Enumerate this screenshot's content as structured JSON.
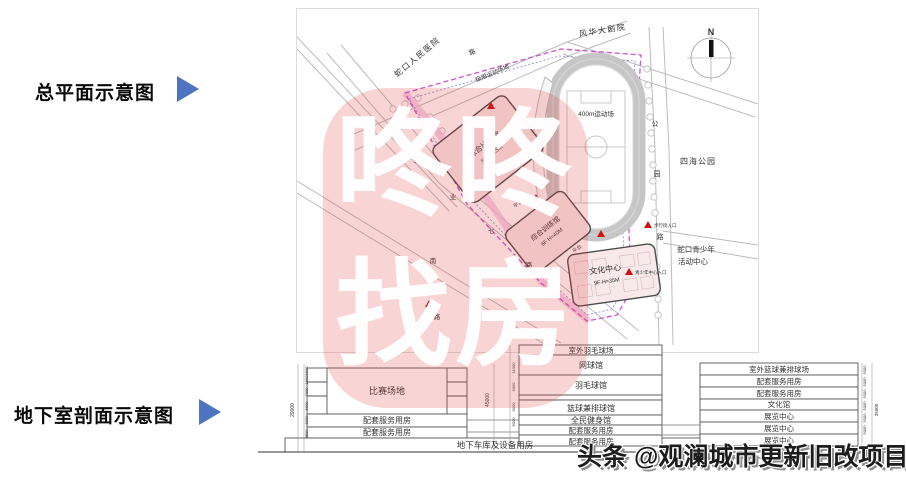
{
  "captions": {
    "siteplan": "总平面示意图",
    "basement": "地下室剖面示意图"
  },
  "watermark": {
    "line1": "咚咚",
    "line2": "找房",
    "color": "#dd3c3c"
  },
  "credit": "头条 @观澜城市更新旧改项目",
  "siteplan": {
    "hospital": "蛇口人民医院",
    "theater": "风华大剧院",
    "greenway": "极限运动场地",
    "road_top_char": "路",
    "park": "四海公园",
    "youth_center_line1": "蛇口青少年",
    "youth_center_line2": "活动中心",
    "track_label": "400m运动场",
    "stand_line1": "5000座",
    "stand_line2": "看台",
    "building1_name": "综合比赛馆",
    "building1_spec": "5F H=25M",
    "building2_name": "综合训练馆",
    "building2_spec": "6F H=40M",
    "building3_name": "文化中心",
    "building3_spec": "9F H=35M",
    "platform1": "平台",
    "platform2": "平台",
    "entrance_walk": "步行街入口",
    "entrance_youth": "青少年中心入口",
    "entrance_generic": "入口",
    "compass_n": "N",
    "road_right_chars": [
      "公",
      "园",
      "路"
    ],
    "road_center_chars": [
      "工",
      "业",
      "七",
      "路"
    ],
    "road_left_chars": [
      "南",
      "水",
      "路"
    ]
  },
  "sections": {
    "left": {
      "hall": "比赛场地",
      "rows": [
        "配套服务用房",
        "配套服务用房"
      ],
      "basement": "地下车库及设备用房",
      "dim_total": "29000",
      "dim_gap": "45000",
      "dims": [
        "1500",
        "1500",
        "7000",
        "5000",
        "6000",
        "4500"
      ]
    },
    "middle": {
      "rows": [
        "室外羽毛球场",
        "网球馆",
        "羽毛球馆",
        "篮球兼排球馆",
        "全民健身馆",
        "配套服务用房",
        "配套服务用房"
      ],
      "dims": [
        "11000",
        "6000",
        "9000",
        "6000"
      ]
    },
    "right": {
      "rows": [
        "室外篮球兼排球场",
        "配套服务用房",
        "配套服务用房",
        "文化馆",
        "展览中心",
        "展览中心",
        "展览中心",
        "图书馆"
      ],
      "dims": [
        "5000",
        "5000",
        "5000",
        "5000",
        "5000",
        "5000"
      ],
      "dim_total": "35000"
    }
  }
}
